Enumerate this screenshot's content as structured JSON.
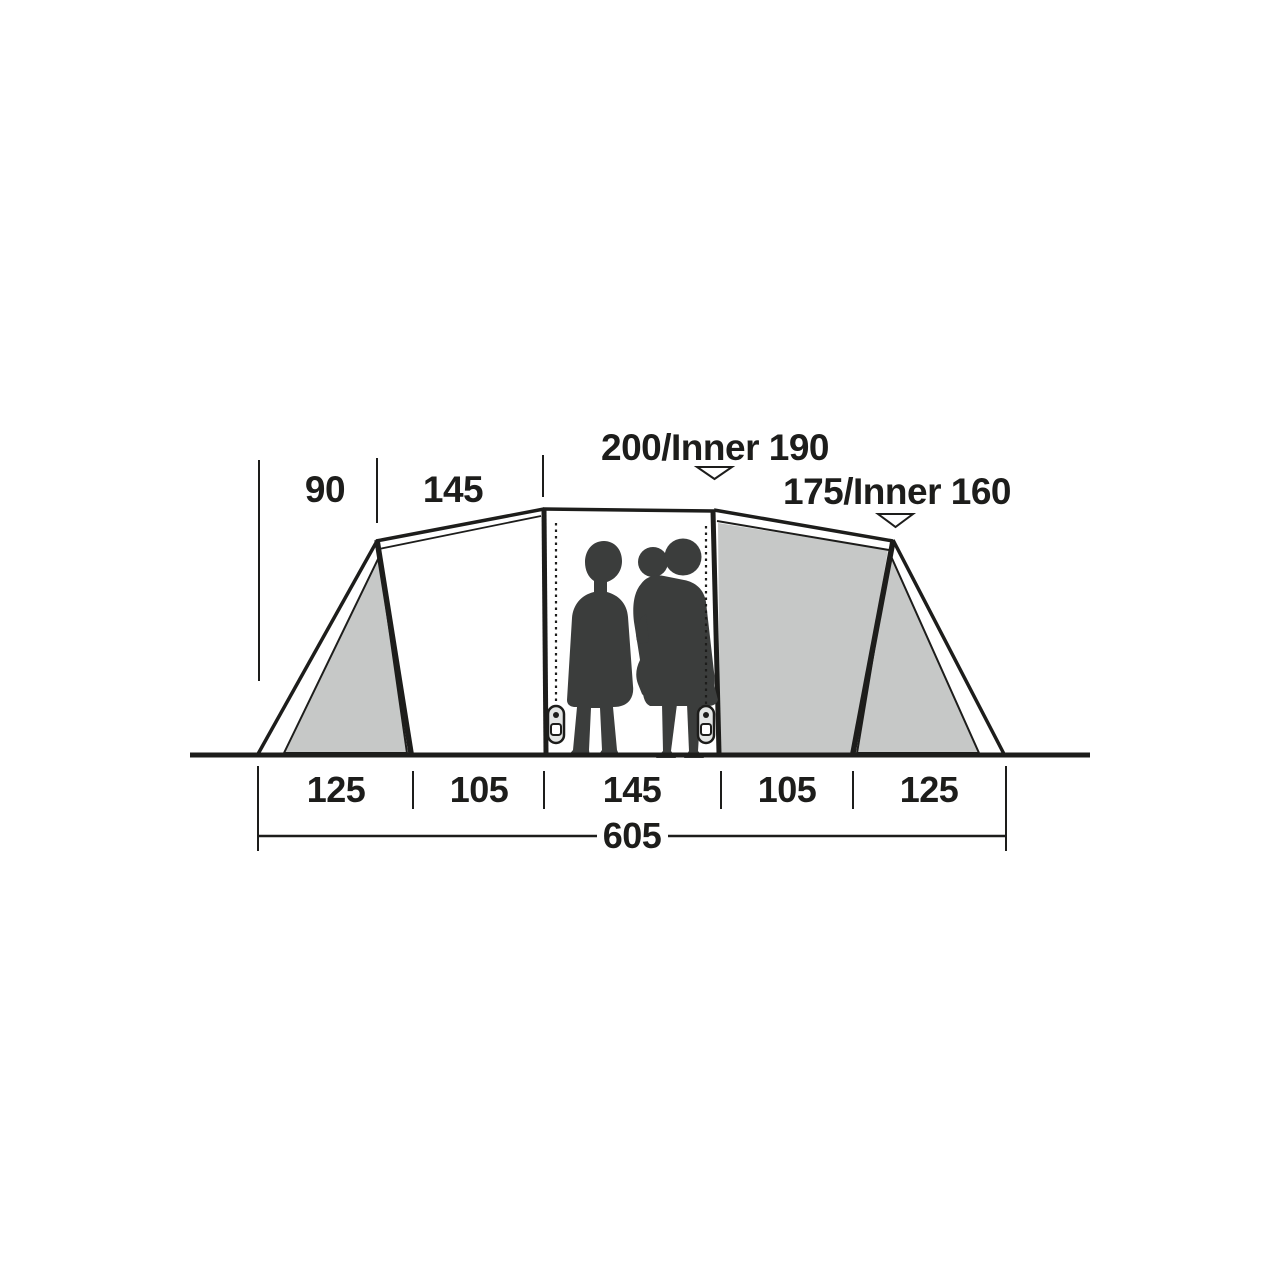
{
  "diagram": {
    "kind": "tent-cross-section-dimension-diagram",
    "top_dimensions": {
      "left_end_width": "90",
      "left_module_width": "145",
      "center_height": "200/Inner 190",
      "bedroom_height": "175/Inner 160"
    },
    "base_segments": [
      "125",
      "105",
      "145",
      "105",
      "125"
    ],
    "total_length": "605",
    "colors": {
      "outline": "#1d1d1b",
      "panel_fill": "#c6c8c7",
      "silhouette_fill": "#3b3d3c",
      "background": "#ffffff"
    }
  }
}
